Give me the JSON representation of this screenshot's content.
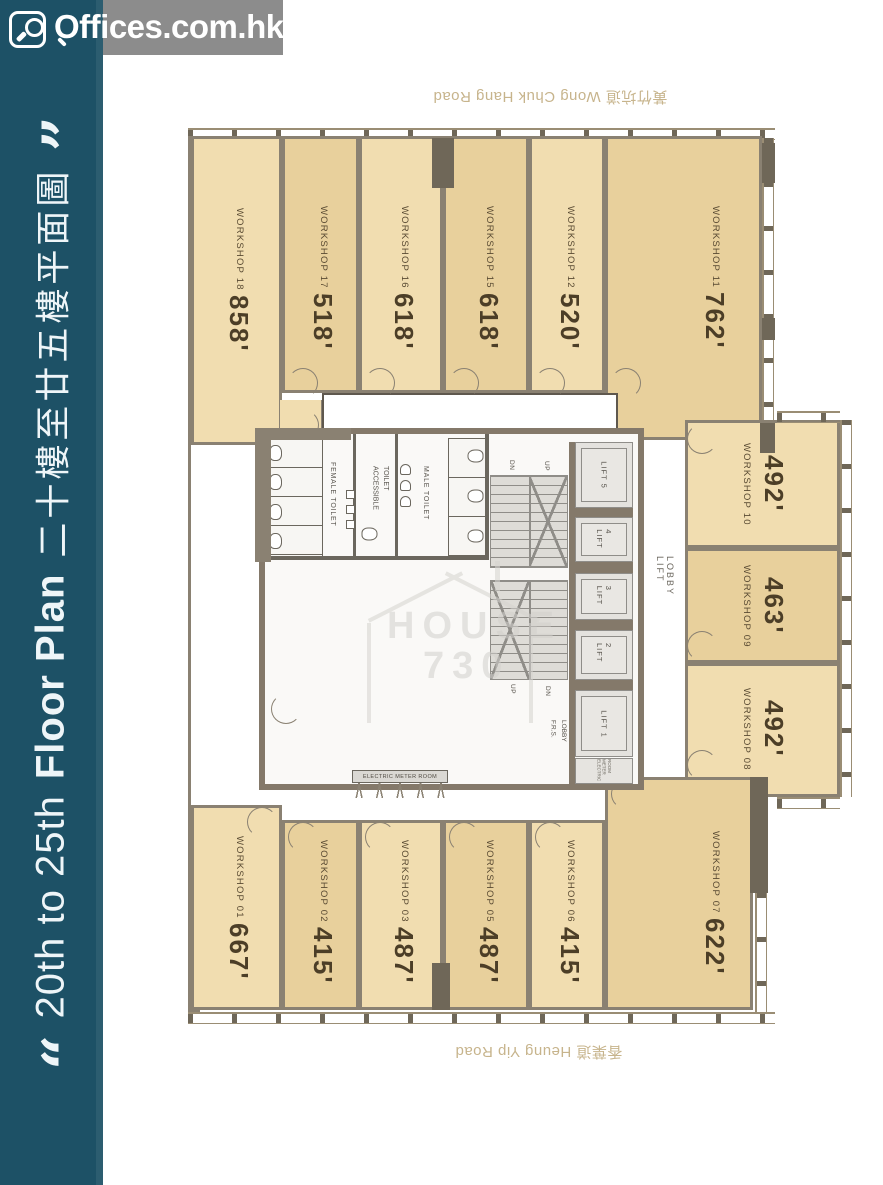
{
  "brand": {
    "logo": "Offices.com.hk"
  },
  "sidebar": {
    "quote_open": "“",
    "quote_close": "”",
    "title_en": "20th to 25th",
    "title_en_bold": "Floor Plan",
    "title_zh": "二十樓至廿五樓平面圖"
  },
  "roads": {
    "top": "黃竹坑道 Wong Chuk Hang Road",
    "bottom": "香葉道 Heung Yip Road"
  },
  "plan": {
    "units": [
      {
        "name": "WORKSHOP 18",
        "area": "858'"
      },
      {
        "name": "WORKSHOP 17",
        "area": "518'"
      },
      {
        "name": "WORKSHOP 16",
        "area": "618'"
      },
      {
        "name": "WORKSHOP 15",
        "area": "618'"
      },
      {
        "name": "WORKSHOP 12",
        "area": "520'"
      },
      {
        "name": "WORKSHOP 11",
        "area": "762'"
      },
      {
        "name": "WORKSHOP 10",
        "area": "492'"
      },
      {
        "name": "WORKSHOP 09",
        "area": "463'"
      },
      {
        "name": "WORKSHOP 08",
        "area": "492'"
      },
      {
        "name": "WORKSHOP 01",
        "area": "667'"
      },
      {
        "name": "WORKSHOP 02",
        "area": "415'"
      },
      {
        "name": "WORKSHOP 03",
        "area": "487'"
      },
      {
        "name": "WORKSHOP 05",
        "area": "487'"
      },
      {
        "name": "WORKSHOP 06",
        "area": "415'"
      },
      {
        "name": "WORKSHOP 07",
        "area": "622'"
      }
    ],
    "core": {
      "female_toilet": "FEMALE TOILET",
      "accessible_toilet": "ACCESSIBLE TOILET",
      "male_toilet": "MALE TOILET",
      "lifts": [
        "LIFT 5",
        "LIFT 4",
        "LIFT 3",
        "LIFT 2",
        "LIFT 1"
      ],
      "lift_lobby": "LIFT LOBBY",
      "frs_lobby": "F.R.S. LOBBY",
      "electric_meter_room": "ELECTRIC METER ROOM",
      "up": "UP",
      "dn": "DN"
    },
    "watermark": {
      "line1": "HOUSE",
      "line2": "730"
    }
  },
  "colors": {
    "sidebar": "#1d5166",
    "logo_bar": "#8c8c8c",
    "unit_light": "#f1ddb0",
    "unit_dark": "#e8d09c",
    "wall": "#8a8172",
    "label_text": "#54462f",
    "road_text": "#c7b48c"
  }
}
